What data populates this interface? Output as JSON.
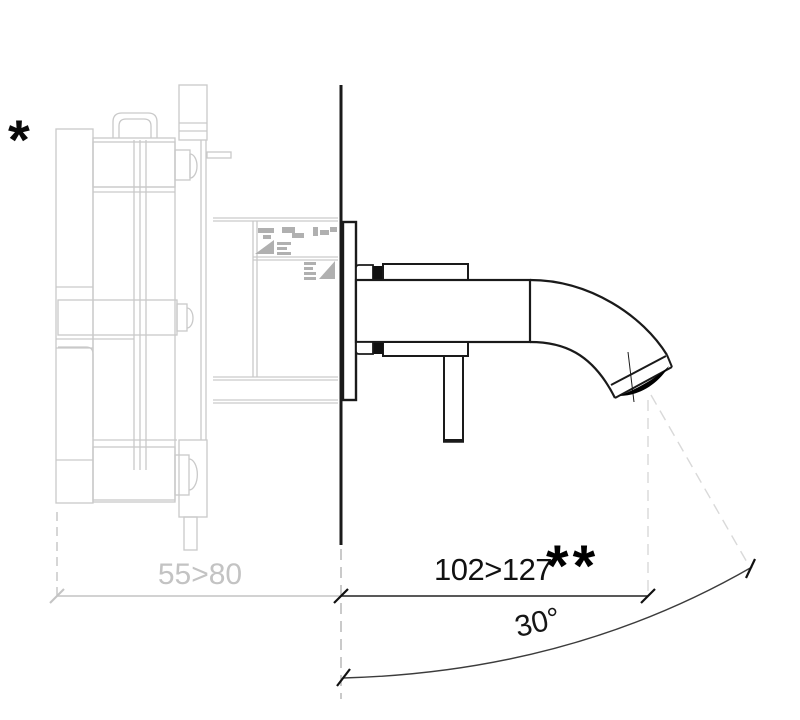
{
  "drawing": {
    "type": "technical-dimension-drawing",
    "subject": "wall-mounted spout, side section with concealed rough-in body",
    "footnotes": {
      "primary": "*",
      "secondary": "**"
    },
    "dimensions": {
      "in_wall_depth": {
        "label": "55>80",
        "appearance": "gray (in-wall rough-in part)"
      },
      "spout_projection": {
        "label": "102>127",
        "footnote_marker": "**"
      },
      "spout_angle": {
        "label": "30°"
      }
    },
    "colors": {
      "fixture_line": "#1a1a1a",
      "rough_in_line": "#c9c9c9",
      "rough_in_detail": "#b0b0b0",
      "dimension_gray": "#c3c3c3",
      "projection_dash": "#d9d9d9",
      "angle_arc": "#3c3c3c",
      "background": "#ffffff"
    }
  }
}
